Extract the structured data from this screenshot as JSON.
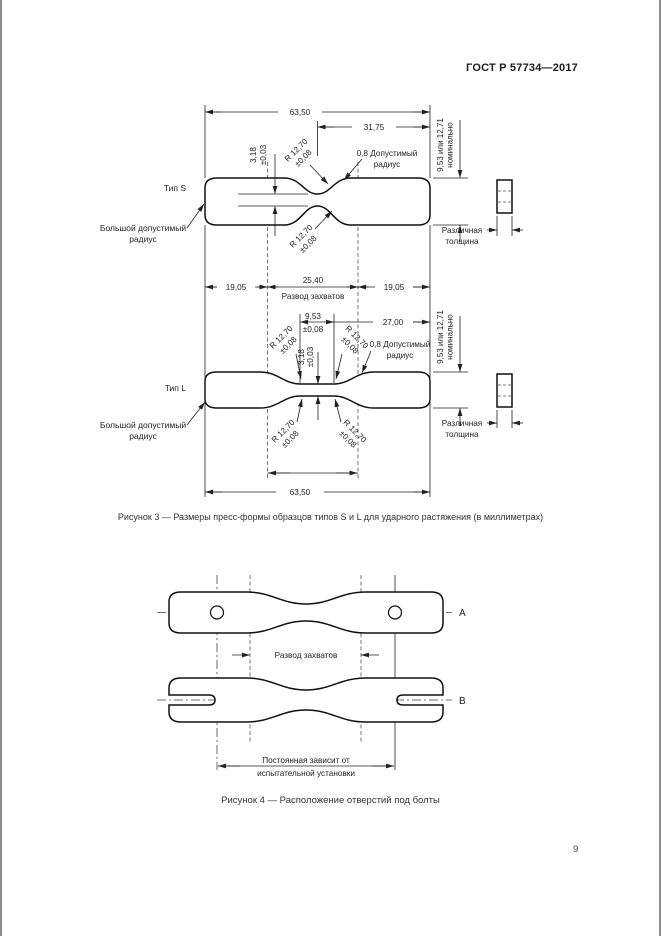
{
  "page": {
    "header": "ГОСТ Р 57734—2017",
    "number": "9"
  },
  "fig3": {
    "caption": "Рисунок 3 — Размеры пресс-формы образцов типов S и L для ударного растяжения (в миллиметрах)",
    "type_s": "Тип S",
    "type_l": "Тип L",
    "dim_overall": "63,50",
    "dim_half": "31,75",
    "dim_grip_side": "19,05",
    "dim_grip_center": "25,40",
    "grip_label": "Развод захватов",
    "dim_width": "3,18",
    "dim_width_tol": "±0,03",
    "dim_radius": "R 12,70",
    "dim_radius_tol": "±0,08",
    "small_radius1": "0,8 Допустимый",
    "small_radius2": "радиус",
    "big_radius1": "Большой допустимый",
    "big_radius2": "радиус",
    "thickness1": "9,53 или 12,71",
    "thickness2": "номинально",
    "var_thickness1": "Различная",
    "var_thickness2": "толщина",
    "dim_narrow_len": "9,53",
    "dim_narrow_len_tol": "±0,08",
    "dim_l_half": "27,00",
    "dim_overall_bottom": "63,50"
  },
  "fig4": {
    "caption": "Рисунок 4 — Расположение отверстий под болты",
    "label_a": "А",
    "label_b": "В",
    "grip_label": "Развод захватов",
    "note1": "Постоянная зависит от",
    "note2": "испытательной установки"
  }
}
